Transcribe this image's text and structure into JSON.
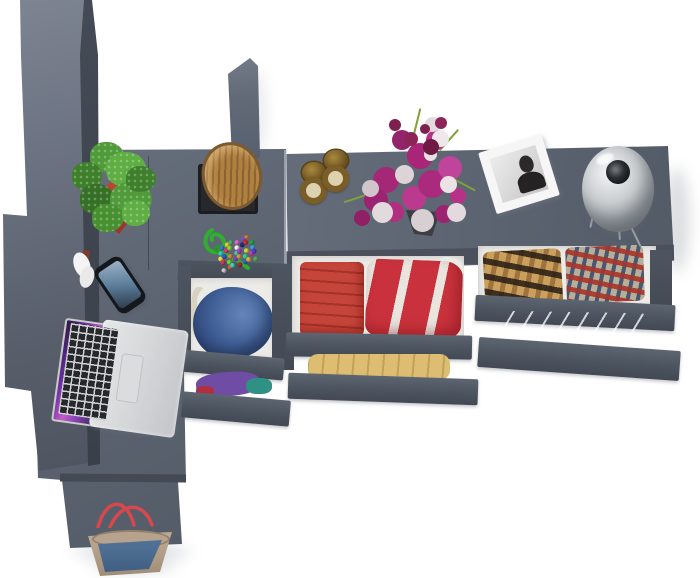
{
  "scene": {
    "kind": "top-down 3d furniture render",
    "colors": {
      "bg": "#ffffff",
      "desk": "#5c6471",
      "desk_edge": "#434a54",
      "wardrobe_light": "#7d8492",
      "wardrobe_dark": "#4e5560",
      "wardrobe_side": "#454b56",
      "drawer_front_dark": "#4a515c",
      "drawer_interior": "#edebe8",
      "pot_red": "#b13c31",
      "leaf_green": "#4f9a39",
      "wood": "#b08040",
      "tray_black": "#26282c",
      "brass": "#7b5e27",
      "sand": "#dcd2b0",
      "flower_magenta": "#b62e86",
      "flower_white": "#e8e1e4",
      "stem_green": "#7fa03a",
      "frame_white": "#f6f6f6",
      "portrait_dark": "#2b2929",
      "lamp_silver": "#c9ccce",
      "lamp_hole": "#15181c",
      "laptop_silver": "#d8dadc",
      "key_black": "#26282c",
      "screen_purple": "#8a41b5",
      "phone_black": "#14171c",
      "phone_screen": "#5d7f9d",
      "cloth_blue": "#3f5f96",
      "cloth_white": "#e9ebe6",
      "cloth_purple": "#6f4da4",
      "cloth_teal": "#2f9184",
      "cloth_red": "#c6453a",
      "cloth_red_stripe": "#c9323c",
      "cloth_yellow": "#dcbd72",
      "cloth_gray": "#bfc2c5",
      "bag_beige": "#b7a28d",
      "bag_blue": "#4e6f93",
      "strap_red": "#d9474e",
      "cord_green": "#2fae2f"
    },
    "items": {
      "wardrobe": {
        "name": "tall gray wardrobe cabinet"
      },
      "desk": {
        "name": "L-shaped dark gray desk"
      },
      "sideboard": {
        "name": "dresser sideboard with open drawers"
      },
      "plant": {
        "name": "green potted plant in red planter"
      },
      "stump": {
        "name": "wood stump decor on black tray"
      },
      "bead_toy": {
        "name": "multicolor bead trinket with green cord",
        "bead_colors": [
          "#d43a3a",
          "#3a7bd4",
          "#e8c23a",
          "#46b26a",
          "#d468c8",
          "#7a52c8",
          "#e07a2e",
          "#3ac8c8",
          "#d43a7e",
          "#8ad43a",
          "#f2f2f2",
          "#2a2a86",
          "#c8322e",
          "#2e9e4e",
          "#e8e23a",
          "#3a56c8",
          "#d4803a",
          "#46c8a0",
          "#b03ad4",
          "#d4d43a",
          "#3aa0d4",
          "#d43a56",
          "#68d43a",
          "#8a3ad4",
          "#d49a3a",
          "#3ad47e",
          "#d43aa8",
          "#5a3ad4",
          "#c8c8c8",
          "#d45e3a",
          "#3ad4c2",
          "#aa2530",
          "#3464c0",
          "#e0b040",
          "#50b050"
        ]
      },
      "hourglasses": {
        "name": "two brass hourglasses",
        "count": 2
      },
      "bouquet": {
        "name": "magenta and white flower bouquet in vase"
      },
      "photo": {
        "name": "white framed black-and-white portrait photo"
      },
      "lamp": {
        "name": "silver dome table lamp"
      },
      "laptop": {
        "name": "open silver laptop with purple wallpaper"
      },
      "phone": {
        "name": "black smartphone with blue lock screen"
      },
      "bag": {
        "name": "beige and blue canvas handbag with red straps"
      },
      "drawers": {
        "left": {
          "top": [
            "blue hoodie",
            "white shirt",
            "cream shirt"
          ],
          "bottom": [
            "purple shirt",
            "teal shirt",
            "red shirt"
          ]
        },
        "middle": {
          "top": [
            "folded red towels",
            "red-white striped garment"
          ],
          "bottom": [
            "yellow folded clothes"
          ]
        },
        "right": {
          "top": [
            "brown plaid shirt",
            "red-blue plaid shirt"
          ],
          "bottom": [
            "gray folded linens"
          ]
        }
      }
    }
  }
}
